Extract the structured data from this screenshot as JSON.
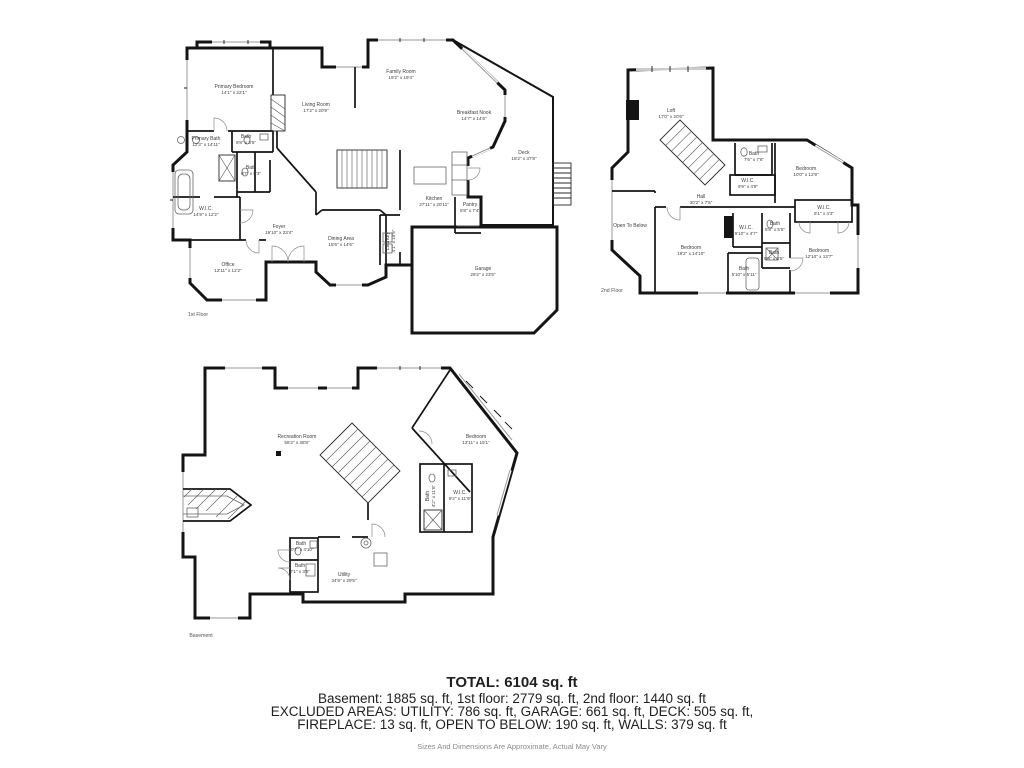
{
  "colors": {
    "background": "#ffffff",
    "wall": "#141414",
    "window": "#9a9a9a",
    "label_text": "#3d3d3d",
    "caption_text": "#555555",
    "summary_text": "#1f1f1f",
    "disclaimer_text": "#8a8a8a"
  },
  "floors": [
    {
      "caption": "1st Floor",
      "caption_x": 198,
      "caption_y": 315,
      "rooms": [
        {
          "name": "Primary Bedroom",
          "dims": "14'1\" x 22'1\"",
          "x": 234,
          "y": 90
        },
        {
          "name": "Living Room",
          "dims": "17'2\" x 20'9\"",
          "x": 316,
          "y": 108
        },
        {
          "name": "Family Room",
          "dims": "19'2\" x 19'4\"",
          "x": 401,
          "y": 75
        },
        {
          "name": "Breakfast Nook",
          "dims": "14'7\" x 14'6\"",
          "x": 474,
          "y": 116
        },
        {
          "name": "Deck",
          "dims": "18'2\" x 37'8\"",
          "x": 524,
          "y": 156
        },
        {
          "name": "Primary Bath",
          "dims": "12'3\" x 14'11\"",
          "x": 206,
          "y": 142
        },
        {
          "name": "Bath",
          "dims": "9'8\" x 3'5\"",
          "x": 246,
          "y": 140
        },
        {
          "name": "Bath",
          "dims": "8'7\" x 5'3\"",
          "x": 251,
          "y": 171
        },
        {
          "name": "W.I.C.",
          "dims": "14'9\" x 12'2\"",
          "x": 206,
          "y": 212
        },
        {
          "name": "Kitchen",
          "dims": "27'11\" x 20'11\"",
          "x": 434,
          "y": 202
        },
        {
          "name": "Pantry",
          "dims": "5'8\" x 7'4\"",
          "x": 470,
          "y": 208
        },
        {
          "name": "Foyer",
          "dims": "19'10\" x 23'4\"",
          "x": 279,
          "y": 230
        },
        {
          "name": "Dining Area",
          "dims": "15'6\" x 14'6\"",
          "x": 341,
          "y": 242
        },
        {
          "name": "Laundry",
          "dims": "4'1\" x 10'9\"",
          "x": 391,
          "y": 241,
          "rotate": 1
        },
        {
          "name": "Office",
          "dims": "12'11\" x 12'2\"",
          "x": 228,
          "y": 268
        },
        {
          "name": "Garage",
          "dims": "29'2\" x 23'5\"",
          "x": 483,
          "y": 272
        }
      ]
    },
    {
      "caption": "2nd Floor",
      "caption_x": 612,
      "caption_y": 291,
      "rooms": [
        {
          "name": "Loft",
          "dims": "17'0\" x 20'6\"",
          "x": 671,
          "y": 114
        },
        {
          "name": "Bath",
          "dims": "7'6\" x 7'6\"",
          "x": 754,
          "y": 157
        },
        {
          "name": "W.I.C.",
          "dims": "9'9\" x 4'9\"",
          "x": 748,
          "y": 184
        },
        {
          "name": "Bedroom",
          "dims": "10'0\" x 12'9\"",
          "x": 806,
          "y": 172
        },
        {
          "name": "Hall",
          "dims": "30'2\" x 7'5\"",
          "x": 701,
          "y": 200
        },
        {
          "name": "Open To Below",
          "dims": "",
          "x": 630,
          "y": 226
        },
        {
          "name": "W.I.C.",
          "dims": "9'1\" x 4'3\"",
          "x": 824,
          "y": 211
        },
        {
          "name": "Bedroom",
          "dims": "19'2\" x 14'10\"",
          "x": 691,
          "y": 251
        },
        {
          "name": "W.I.C.",
          "dims": "9'10\" x 4'7\"",
          "x": 746,
          "y": 231
        },
        {
          "name": "Bath",
          "dims": "5'8\" x 5'5\"",
          "x": 775,
          "y": 227
        },
        {
          "name": "Bath",
          "dims": "5'9\" x 3'5\"",
          "x": 774,
          "y": 256
        },
        {
          "name": "Bedroom",
          "dims": "12'10\" x 13'7\"",
          "x": 819,
          "y": 254
        },
        {
          "name": "Bath",
          "dims": "5'10\" x 5'11\"",
          "x": 744,
          "y": 272
        }
      ]
    },
    {
      "caption": "Basement",
      "caption_x": 201,
      "caption_y": 636,
      "rooms": [
        {
          "name": "Recreation Room",
          "dims": "56'2\" x 38'8\"",
          "x": 297,
          "y": 440
        },
        {
          "name": "Bedroom",
          "dims": "13'11\" x 15'1\"",
          "x": 476,
          "y": 440
        },
        {
          "name": "Bath",
          "dims": "4'2\" x 11'6\"",
          "x": 431,
          "y": 496,
          "rotate": 1
        },
        {
          "name": "W.I.C.",
          "dims": "9'2\" x 11'9\"",
          "x": 460,
          "y": 496
        },
        {
          "name": "Bath",
          "dims": "10'7\" x 4'10\"",
          "x": 301,
          "y": 547
        },
        {
          "name": "Bath",
          "dims": "7'1\" x 3'5\"",
          "x": 300,
          "y": 569
        },
        {
          "name": "Utility",
          "dims": "34'9\" x 29'5\"",
          "x": 344,
          "y": 578
        }
      ]
    }
  ],
  "summary": {
    "total": "TOTAL: 6104 sq. ft",
    "line1": "Basement: 1885 sq. ft, 1st floor: 2779 sq. ft, 2nd floor: 1440 sq. ft",
    "line2": "EXCLUDED AREAS: UTILITY: 786 sq. ft, GARAGE: 661 sq. ft, DECK: 505 sq. ft,",
    "line3": "FIREPLACE: 13 sq. ft, OPEN TO BELOW: 190 sq. ft, WALLS: 379 sq. ft",
    "disclaimer": "Sizes And Dimensions Are Approximate, Actual May Vary"
  }
}
